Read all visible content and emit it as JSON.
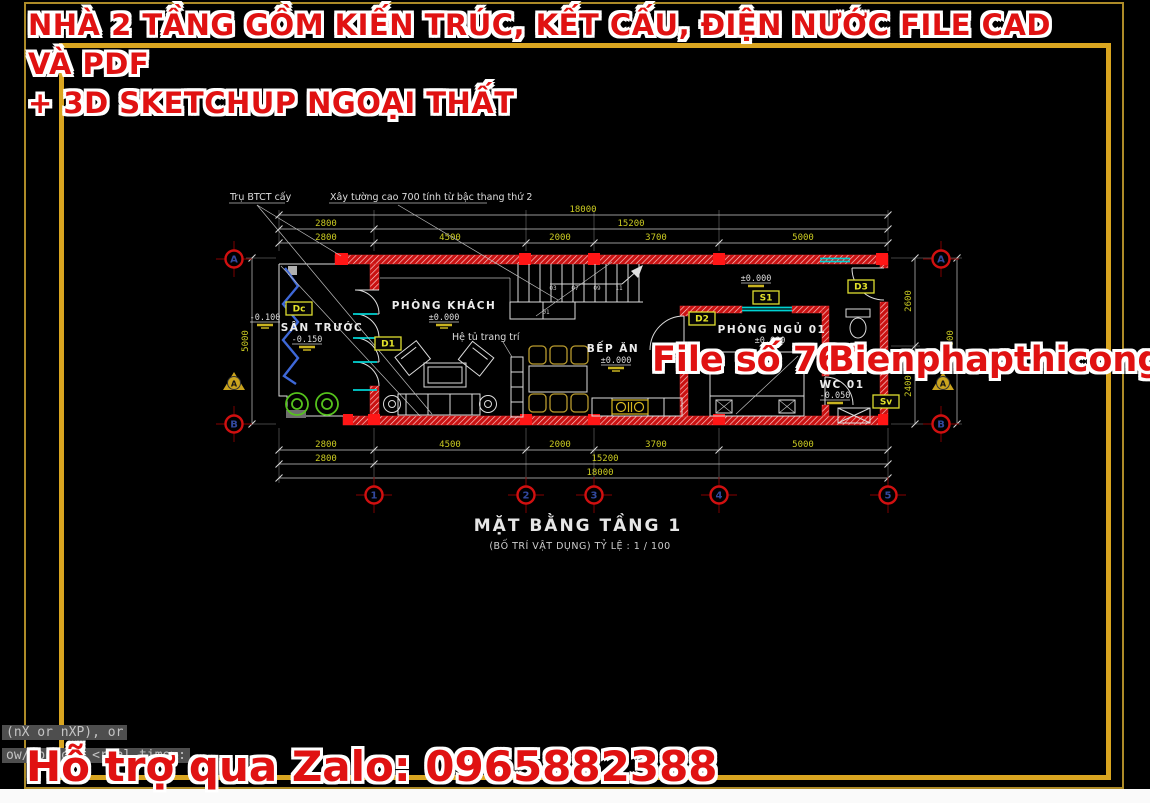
{
  "header": {
    "line1": "NHÀ 2 TẦNG GỒM KIẾN TRÚC, KẾT CẤU, ĐIỆN NƯỚC FILE CAD VÀ PDF",
    "line2": "+ 3D SKETCHUP NGOẠI THẤT"
  },
  "watermark": {
    "file_no": "File số 764",
    "website": "Bienphapthicong.vn"
  },
  "support": {
    "text": "Hỗ trợ qua Zalo: 0965882388"
  },
  "command": {
    "line1": "(nX or nXP), or",
    "line2": "ow/Object] <real time>:"
  },
  "plan": {
    "title": "MẶT BẰNG TẦNG 1",
    "subtitle": "(BỐ TRÍ VẬT DỤNG) TỶ LỆ : 1 / 100",
    "notes": {
      "pier": "Trụ BTCT cấy",
      "wall": "Xây tường cao 700 tính từ bậc thang thứ 2",
      "cabinet": "Hệ tủ trang trí"
    },
    "rooms": {
      "porch": {
        "name": "SÂN TRƯỚC",
        "level": "-0.150"
      },
      "porch_outside_level": "-0.100",
      "living": {
        "name": "PHÒNG KHÁCH",
        "level": "±0.000"
      },
      "kitchen": {
        "name": "BẾP ĂN",
        "level": "±0.000"
      },
      "bedroom": {
        "name": "PHÒNG NGỦ 01",
        "level": "±0.000"
      },
      "wc": {
        "name": "WC 01",
        "level": "-0.050"
      },
      "stair_level": "±0.000"
    },
    "tags": {
      "dc": "Dc",
      "d1": "D1",
      "d2": "D2",
      "d3": "D3",
      "s1": "S1",
      "sv": "Sv"
    },
    "dims": {
      "top_overall": "18000",
      "top_mid": [
        "2800",
        "15200"
      ],
      "top_detail": [
        "2800",
        "4500",
        "2000",
        "3700",
        "5000"
      ],
      "bottom_detail": [
        "2800",
        "4500",
        "2000",
        "3700",
        "5000"
      ],
      "bottom_mid": [
        "2800",
        "15200"
      ],
      "bottom_overall": "18000",
      "left_overall": "5000",
      "right_detail": [
        "2600",
        "2400"
      ],
      "right_overall": "5000"
    },
    "grid": {
      "cols": [
        "1",
        "2",
        "3",
        "4",
        "5"
      ],
      "rows": [
        "A",
        "B"
      ]
    },
    "section_marker": "A",
    "stair_steps": [
      "01",
      "03",
      "07",
      "09",
      "11"
    ]
  },
  "colors": {
    "accent_red": "#e01212",
    "frame_gold": "#d9a520",
    "dim_yellow": "#cbcb22",
    "wall_red": "#d01010",
    "window_cyan": "#00d2d2"
  }
}
